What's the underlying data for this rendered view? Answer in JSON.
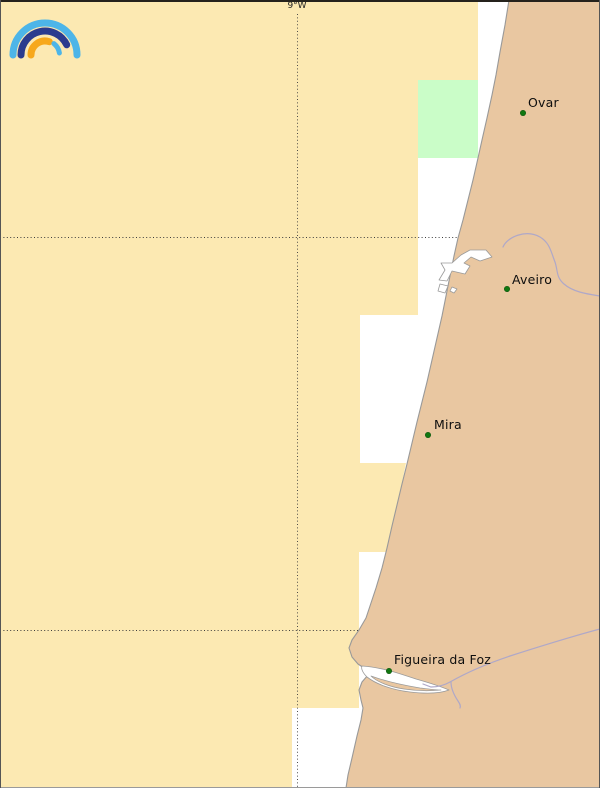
{
  "map": {
    "grid": {
      "meridian_label": "9°W",
      "meridian_pos": {
        "x": 297,
        "y": 1
      }
    },
    "cities": [
      {
        "name": "Ovar",
        "dot": {
          "x": 523,
          "y": 113
        },
        "label": {
          "x": 528,
          "y": 95
        }
      },
      {
        "name": "Aveiro",
        "dot": {
          "x": 507,
          "y": 289
        },
        "label": {
          "x": 512,
          "y": 272
        }
      },
      {
        "name": "Mira",
        "dot": {
          "x": 428,
          "y": 435
        },
        "label": {
          "x": 434,
          "y": 417
        }
      },
      {
        "name": "Figueira da Foz",
        "dot": {
          "x": 389,
          "y": 671
        },
        "label": {
          "x": 394,
          "y": 652
        }
      }
    ],
    "colors": {
      "sea_area_yellow": "#fce9b2",
      "sea_area_green": "#cafdc8",
      "sea_gap_white": "#ffffff",
      "land": "#e9c7a1",
      "coastline": "#999999",
      "river": "#afa8c8",
      "city_dot": "#117711",
      "grid_line": "#3c3c3c",
      "frame_top": "#25221c",
      "frame_side": "#555555",
      "frame_bottom": "#9a9a9a"
    },
    "logo": {
      "icon": "rainbow-arcs-logo",
      "arc_colors": [
        "#4db5e8",
        "#2b3b8e",
        "#f7a81b",
        "#4db5e8"
      ]
    }
  }
}
